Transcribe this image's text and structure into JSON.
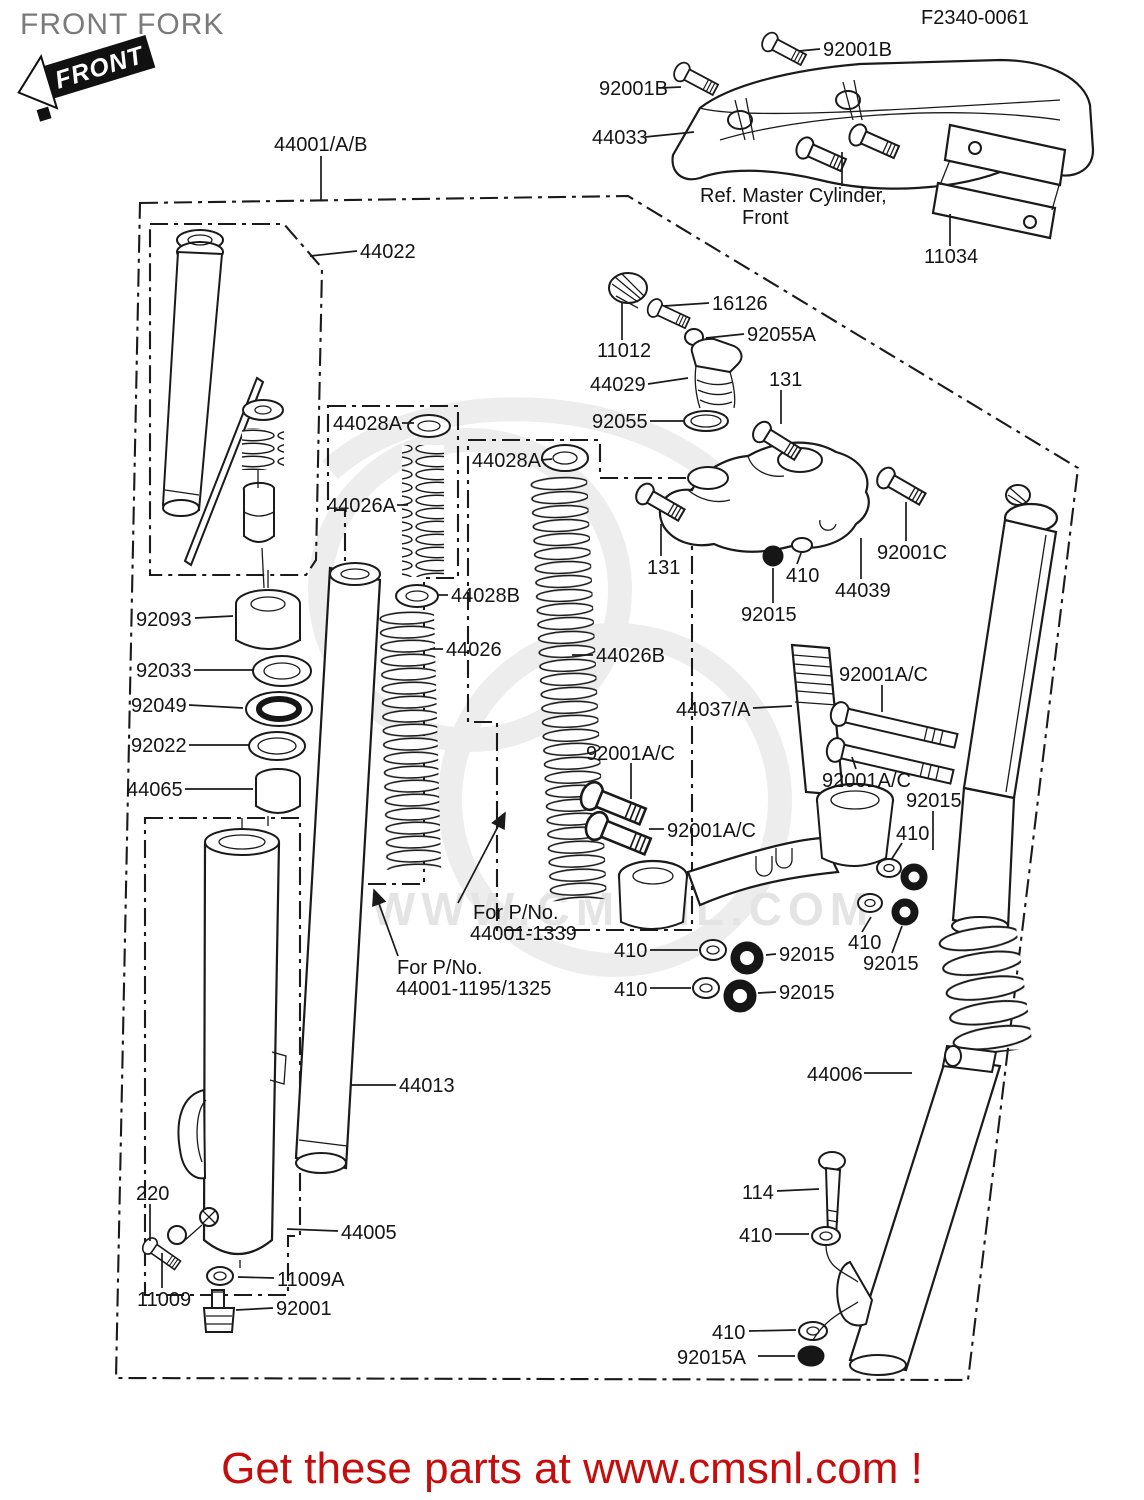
{
  "header": {
    "title": "FRONT FORK",
    "badge_text": "FRONT",
    "fiche_code": "F2340-0061"
  },
  "footer": {
    "banner": "Get these parts at www.cmsnl.com !",
    "banner_color": "#c60d0d"
  },
  "watermark": {
    "text": "WWW.CMSNL.COM"
  },
  "colors": {
    "ink": "#1a1a1a",
    "title_gray": "#7a7a7a",
    "watermark_gray": "#e4e4e4"
  },
  "diagram": {
    "labels": [
      {
        "id": "fiche-code",
        "text": "F2340-0061",
        "x": 921,
        "y": 24,
        "fs": 18
      },
      {
        "id": "92001b-top",
        "text": "92001B",
        "x": 823,
        "y": 56,
        "leader": [
          [
            820,
            49
          ],
          [
            799,
            51
          ]
        ]
      },
      {
        "id": "92001b-left",
        "text": "92001B",
        "x": 599,
        "y": 95,
        "leader": [
          [
            659,
            88
          ],
          [
            681,
            87
          ]
        ]
      },
      {
        "id": "44033",
        "text": "44033",
        "x": 592,
        "y": 144,
        "leader": [
          [
            645,
            137
          ],
          [
            694,
            132
          ]
        ]
      },
      {
        "id": "ref-master-1",
        "text": "Ref. Master Cylinder,",
        "x": 700,
        "y": 202,
        "leader": [
          [
            842,
            186
          ],
          [
            842,
            152
          ]
        ]
      },
      {
        "id": "ref-master-2",
        "text": "Front",
        "x": 742,
        "y": 224
      },
      {
        "id": "11034",
        "text": "11034",
        "x": 924,
        "y": 263,
        "leader": [
          [
            950,
            246
          ],
          [
            950,
            214
          ]
        ]
      },
      {
        "id": "44001ab",
        "text": "44001/A/B",
        "x": 274,
        "y": 151,
        "leader": [
          [
            321,
            156
          ],
          [
            321,
            200
          ]
        ]
      },
      {
        "id": "44022",
        "text": "44022",
        "x": 360,
        "y": 258,
        "leader": [
          [
            357,
            251
          ],
          [
            310,
            256
          ]
        ]
      },
      {
        "id": "16126",
        "text": "16126",
        "x": 712,
        "y": 310,
        "leader": [
          [
            709,
            303
          ],
          [
            664,
            306
          ]
        ]
      },
      {
        "id": "92055a",
        "text": "92055A",
        "x": 747,
        "y": 341,
        "leader": [
          [
            744,
            334
          ],
          [
            706,
            338
          ]
        ]
      },
      {
        "id": "11012",
        "text": "11012",
        "x": 597,
        "y": 357,
        "leader": [
          [
            622,
            340
          ],
          [
            622,
            302
          ]
        ]
      },
      {
        "id": "44029",
        "text": "44029",
        "x": 590,
        "y": 391,
        "leader": [
          [
            648,
            384
          ],
          [
            688,
            378
          ]
        ]
      },
      {
        "id": "131-upper",
        "text": "131",
        "x": 769,
        "y": 386,
        "leader": [
          [
            781,
            390
          ],
          [
            781,
            424
          ]
        ]
      },
      {
        "id": "92055",
        "text": "92055",
        "x": 592,
        "y": 428,
        "leader": [
          [
            650,
            421
          ],
          [
            684,
            421
          ]
        ]
      },
      {
        "id": "44028a-1",
        "text": "44028A",
        "x": 333,
        "y": 430,
        "leader": [
          [
            402,
            423
          ],
          [
            414,
            423
          ]
        ]
      },
      {
        "id": "44026a",
        "text": "44026A",
        "x": 327,
        "y": 512,
        "leader": [
          [
            397,
            505
          ],
          [
            408,
            505
          ]
        ]
      },
      {
        "id": "44028a-2",
        "text": "44028A",
        "x": 472,
        "y": 467,
        "leader": [
          [
            541,
            460
          ],
          [
            552,
            459
          ]
        ]
      },
      {
        "id": "92001c",
        "text": "92001C",
        "x": 877,
        "y": 559,
        "leader": [
          [
            906,
            541
          ],
          [
            906,
            502
          ]
        ]
      },
      {
        "id": "131-lower",
        "text": "131",
        "x": 647,
        "y": 574,
        "leader": [
          [
            661,
            556
          ],
          [
            661,
            524
          ]
        ]
      },
      {
        "id": "410-crown",
        "text": "410",
        "x": 786,
        "y": 582,
        "leader": [
          [
            797,
            564
          ],
          [
            801,
            553
          ]
        ]
      },
      {
        "id": "44039",
        "text": "44039",
        "x": 835,
        "y": 597,
        "leader": [
          [
            861,
            579
          ],
          [
            861,
            538
          ]
        ]
      },
      {
        "id": "92015-crown",
        "text": "92015",
        "x": 741,
        "y": 621,
        "leader": [
          [
            773,
            603
          ],
          [
            773,
            568
          ]
        ]
      },
      {
        "id": "44028b",
        "text": "44028B",
        "x": 451,
        "y": 602,
        "leader": [
          [
            448,
            595
          ],
          [
            438,
            595
          ]
        ]
      },
      {
        "id": "44026",
        "text": "44026",
        "x": 446,
        "y": 656,
        "leader": [
          [
            443,
            649
          ],
          [
            430,
            649
          ]
        ]
      },
      {
        "id": "44026b",
        "text": "44026B",
        "x": 596,
        "y": 662,
        "leader": [
          [
            593,
            655
          ],
          [
            572,
            655
          ]
        ]
      },
      {
        "id": "44037a",
        "text": "44037/A",
        "x": 676,
        "y": 716,
        "leader": [
          [
            753,
            708
          ],
          [
            792,
            706
          ]
        ]
      },
      {
        "id": "92001ac-1",
        "text": "92001A/C",
        "x": 839,
        "y": 681,
        "leader": [
          [
            882,
            685
          ],
          [
            882,
            712
          ]
        ]
      },
      {
        "id": "92001ac-2",
        "text": "92001A/C",
        "x": 586,
        "y": 760,
        "leader": [
          [
            631,
            763
          ],
          [
            631,
            799
          ]
        ]
      },
      {
        "id": "92001ac-3",
        "text": "92001A/C",
        "x": 822,
        "y": 787,
        "leader": [
          [
            856,
            769
          ],
          [
            852,
            757
          ]
        ]
      },
      {
        "id": "92015-r1",
        "text": "92015",
        "x": 906,
        "y": 807,
        "leader": [
          [
            933,
            811
          ],
          [
            933,
            850
          ]
        ]
      },
      {
        "id": "410-r1",
        "text": "410",
        "x": 896,
        "y": 840,
        "leader": [
          [
            902,
            843
          ],
          [
            891,
            860
          ]
        ]
      },
      {
        "id": "92001ac-4",
        "text": "92001A/C",
        "x": 667,
        "y": 837,
        "leader": [
          [
            664,
            829
          ],
          [
            649,
            829
          ]
        ]
      },
      {
        "id": "forpno-1a",
        "text": "For P/No.",
        "x": 473,
        "y": 919
      },
      {
        "id": "forpno-1b",
        "text": "44001-1339",
        "x": 470,
        "y": 940,
        "arrow": true,
        "leader": [
          [
            458,
            903
          ],
          [
            505,
            813
          ]
        ]
      },
      {
        "id": "forpno-2a",
        "text": "For P/No.",
        "x": 397,
        "y": 974
      },
      {
        "id": "forpno-2b",
        "text": "44001-1195/1325",
        "x": 396,
        "y": 995,
        "arrow": true,
        "leader": [
          [
            398,
            956
          ],
          [
            374,
            890
          ]
        ]
      },
      {
        "id": "410-row1",
        "text": "410",
        "x": 614,
        "y": 957,
        "leader": [
          [
            650,
            950
          ],
          [
            698,
            950
          ]
        ]
      },
      {
        "id": "92015-row1",
        "text": "92015",
        "x": 779,
        "y": 961,
        "leader": [
          [
            776,
            954
          ],
          [
            766,
            955
          ]
        ]
      },
      {
        "id": "410-row2",
        "text": "410",
        "x": 614,
        "y": 996,
        "leader": [
          [
            650,
            988
          ],
          [
            691,
            988
          ]
        ]
      },
      {
        "id": "92015-row2",
        "text": "92015",
        "x": 779,
        "y": 999,
        "leader": [
          [
            776,
            992
          ],
          [
            758,
            993
          ]
        ]
      },
      {
        "id": "410-cl",
        "text": "410",
        "x": 848,
        "y": 949,
        "leader": [
          [
            862,
            932
          ],
          [
            871,
            917
          ]
        ]
      },
      {
        "id": "92015-cl",
        "text": "92015",
        "x": 863,
        "y": 970,
        "leader": [
          [
            892,
            953
          ],
          [
            902,
            926
          ]
        ]
      },
      {
        "id": "44013",
        "text": "44013",
        "x": 399,
        "y": 1092,
        "leader": [
          [
            396,
            1085
          ],
          [
            351,
            1085
          ]
        ]
      },
      {
        "id": "44006",
        "text": "44006",
        "x": 807,
        "y": 1081,
        "leader": [
          [
            864,
            1073
          ],
          [
            912,
            1073
          ]
        ]
      },
      {
        "id": "220",
        "text": "220",
        "x": 136,
        "y": 1200,
        "leader": [
          [
            150,
            1204
          ],
          [
            150,
            1241
          ]
        ]
      },
      {
        "id": "44005",
        "text": "44005",
        "x": 341,
        "y": 1239,
        "leader": [
          [
            338,
            1231
          ],
          [
            287,
            1229
          ]
        ]
      },
      {
        "id": "11009a",
        "text": "11009A",
        "x": 277,
        "y": 1286,
        "leader": [
          [
            274,
            1278
          ],
          [
            238,
            1277
          ]
        ]
      },
      {
        "id": "11009",
        "text": "11009",
        "x": 137,
        "y": 1306,
        "leader": [
          [
            162,
            1288
          ],
          [
            162,
            1253
          ]
        ]
      },
      {
        "id": "92001-bottom",
        "text": "92001",
        "x": 276,
        "y": 1315,
        "leader": [
          [
            273,
            1308
          ],
          [
            236,
            1310
          ]
        ]
      },
      {
        "id": "114",
        "text": "114",
        "x": 742,
        "y": 1199,
        "leader": [
          [
            777,
            1191
          ],
          [
            819,
            1189
          ]
        ]
      },
      {
        "id": "410-br1",
        "text": "410",
        "x": 739,
        "y": 1242,
        "leader": [
          [
            775,
            1234
          ],
          [
            809,
            1234
          ]
        ]
      },
      {
        "id": "410-br2",
        "text": "410",
        "x": 712,
        "y": 1339,
        "leader": [
          [
            749,
            1331
          ],
          [
            796,
            1330
          ]
        ]
      },
      {
        "id": "92015a-label",
        "text": "92015A",
        "x": 677,
        "y": 1364,
        "leader": [
          [
            758,
            1356
          ],
          [
            795,
            1356
          ]
        ]
      },
      {
        "id": "92093",
        "text": "92093",
        "x": 136,
        "y": 626,
        "leader": [
          [
            195,
            618
          ],
          [
            233,
            616
          ]
        ]
      },
      {
        "id": "92033",
        "text": "92033",
        "x": 136,
        "y": 677,
        "leader": [
          [
            194,
            670
          ],
          [
            253,
            670
          ]
        ]
      },
      {
        "id": "92049",
        "text": "92049",
        "x": 131,
        "y": 712,
        "leader": [
          [
            189,
            705
          ],
          [
            243,
            708
          ]
        ]
      },
      {
        "id": "92022",
        "text": "92022",
        "x": 131,
        "y": 752,
        "leader": [
          [
            189,
            745
          ],
          [
            249,
            745
          ]
        ]
      },
      {
        "id": "44065",
        "text": "44065",
        "x": 127,
        "y": 796,
        "leader": [
          [
            185,
            789
          ],
          [
            253,
            789
          ]
        ]
      }
    ]
  }
}
